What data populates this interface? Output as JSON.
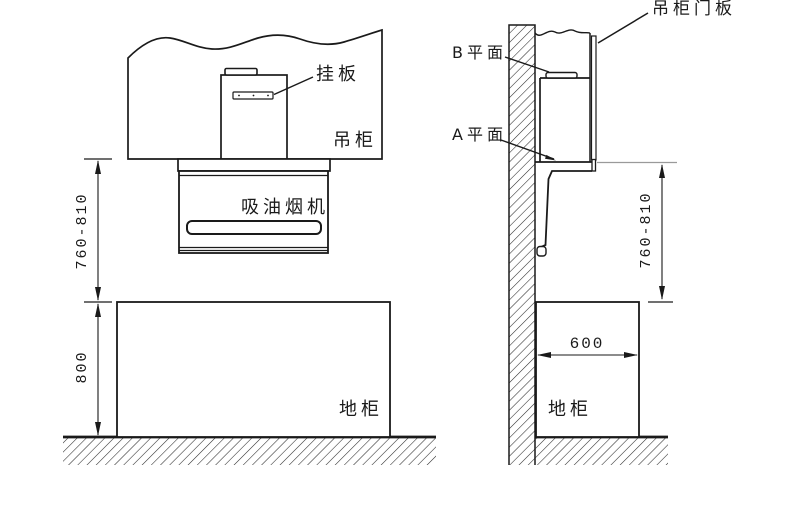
{
  "diagram": {
    "kind": "range-hood-installation-drawing",
    "line_color": "#1a1a1a",
    "extension_line_color": "#9a9a9a",
    "front_view": {
      "labels": {
        "hanging_plate": "挂板",
        "wall_cabinet": "吊柜",
        "range_hood": "吸油烟机",
        "base_cabinet": "地柜"
      },
      "dimensions": {
        "hood_bottom_to_countertop": "760-810",
        "base_cabinet_height": "800"
      }
    },
    "side_view": {
      "labels": {
        "wall_cabinet_door_panel": "吊柜门板",
        "plane_b": "B平面",
        "plane_a": "A平面",
        "base_cabinet": "地柜"
      },
      "dimensions": {
        "hood_bottom_to_countertop": "760-810",
        "base_cabinet_depth": "600"
      }
    }
  }
}
